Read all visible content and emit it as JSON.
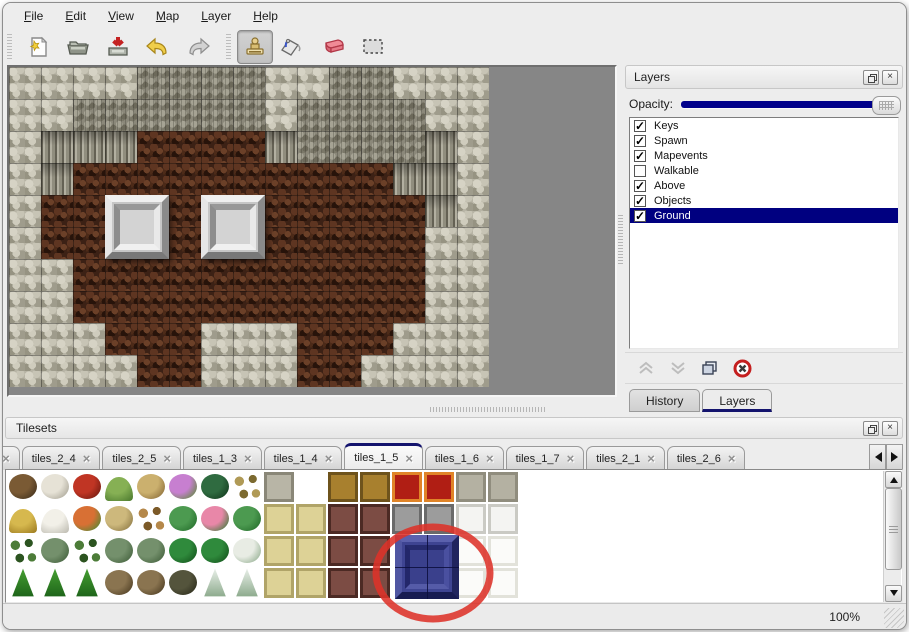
{
  "menu": {
    "items": [
      "File",
      "Edit",
      "View",
      "Map",
      "Layer",
      "Help"
    ]
  },
  "toolbar": {
    "tools": [
      "new-file",
      "open",
      "save",
      "undo",
      "redo",
      "stamp",
      "fill",
      "eraser",
      "select"
    ],
    "active_tool": "stamp"
  },
  "icons": {
    "close": "×"
  },
  "layers_panel": {
    "title": "Layers",
    "opacity_label": "Opacity:",
    "opacity_value_fraction": 1.0,
    "layers": [
      {
        "name": "Keys",
        "checked": true,
        "selected": false
      },
      {
        "name": "Spawn",
        "checked": true,
        "selected": false
      },
      {
        "name": "Mapevents",
        "checked": true,
        "selected": false
      },
      {
        "name": "Walkable",
        "checked": false,
        "selected": false
      },
      {
        "name": "Above",
        "checked": true,
        "selected": false
      },
      {
        "name": "Objects",
        "checked": true,
        "selected": false
      },
      {
        "name": "Ground",
        "checked": true,
        "selected": true
      }
    ],
    "buttons": [
      "move-layer-up",
      "move-layer-down",
      "duplicate-layer",
      "delete-layer"
    ],
    "tabs": [
      {
        "label": "History",
        "active": false
      },
      {
        "label": "Layers",
        "active": true
      }
    ],
    "colors": {
      "selection": "#000080",
      "slider": "#00008b"
    }
  },
  "tilesets_panel": {
    "title": "Tilesets",
    "tabs": [
      {
        "label": "3",
        "active": false,
        "cut": true
      },
      {
        "label": "tiles_2_4",
        "active": false
      },
      {
        "label": "tiles_2_5",
        "active": false
      },
      {
        "label": "tiles_1_3",
        "active": false
      },
      {
        "label": "tiles_1_4",
        "active": false
      },
      {
        "label": "tiles_1_5",
        "active": true
      },
      {
        "label": "tiles_1_6",
        "active": false
      },
      {
        "label": "tiles_1_7",
        "active": false
      },
      {
        "label": "tiles_2_1",
        "active": false
      },
      {
        "label": "tiles_2_6",
        "active": false
      }
    ],
    "grid": [
      [
        [
          "blob",
          "#7a5a34",
          "#40301c"
        ],
        [
          "blob",
          "#e6e2d6",
          "#a8a496"
        ],
        [
          "blob",
          "#c03524",
          "#6e1a10"
        ],
        [
          "mound",
          "#86b054",
          "#4e7c30"
        ],
        [
          "blob",
          "#cbb06e",
          "#8a6c38"
        ],
        [
          "blob",
          "#c77fd0",
          "#5e8a3c"
        ],
        [
          "blob",
          "#2f6b40",
          "#133a1e"
        ],
        [
          "sprig",
          "#b09a56",
          "#7c6a30"
        ],
        [
          "flat",
          "#b8b5a6",
          "#8a8778"
        ],
        null,
        [
          "flat",
          "#a8802e",
          "#6e531c"
        ],
        [
          "flat",
          "#a8802e",
          "#6e531c"
        ],
        [
          "flat",
          "#b01e14",
          "#e08428"
        ],
        [
          "flat",
          "#b01e14",
          "#e08428"
        ],
        [
          "flat",
          "#b4b1a2",
          "#908d7e"
        ],
        [
          "flat",
          "#b4b1a2",
          "#908d7e"
        ]
      ],
      [
        [
          "mound",
          "#d6b84e",
          "#a07e22"
        ],
        [
          "mound",
          "#f2f0e8",
          "#c0beb4"
        ],
        [
          "blob",
          "#d87034",
          "#4e8a34"
        ],
        [
          "blob",
          "#cdb87c",
          "#8c7844"
        ],
        [
          "sprig",
          "#b5884a",
          "#7c5a28"
        ],
        [
          "blob",
          "#4c9a50",
          "#256e2c"
        ],
        [
          "blob",
          "#e887a8",
          "#3c7c3c"
        ],
        [
          "blob",
          "#4c9a50",
          "#256e2c"
        ],
        [
          "flat",
          "#ddd296",
          "#b0a468"
        ],
        [
          "flat",
          "#ddd296",
          "#b0a468"
        ],
        [
          "flat",
          "#7c4c44",
          "#4c2a24"
        ],
        [
          "flat",
          "#7c4c44",
          "#4c2a24"
        ],
        [
          "flat",
          "#9c9c9c",
          "#6a6a6a"
        ],
        [
          "flat",
          "#9c9c9c",
          "#6a6a6a"
        ],
        [
          "flat",
          "#f4f4f2",
          "#cacac4"
        ],
        [
          "flat",
          "#f4f4f2",
          "#cacac4"
        ]
      ],
      [
        [
          "sprig",
          "#4c7c38",
          "#2c5420"
        ],
        [
          "blob",
          "#74906c",
          "#42603c"
        ],
        [
          "sprig",
          "#4c7c38",
          "#2c5420"
        ],
        [
          "blob",
          "#74906c",
          "#42603c"
        ],
        [
          "blob",
          "#74906c",
          "#42603c"
        ],
        [
          "blob",
          "#2f8a3c",
          "#14541c"
        ],
        [
          "blob",
          "#2f8a3c",
          "#14541c"
        ],
        [
          "blob",
          "#e8ece4",
          "#92ae90"
        ],
        [
          "flat",
          "#ddd296",
          "#b0a468"
        ],
        [
          "flat",
          "#ddd296",
          "#b0a468"
        ],
        [
          "flat",
          "#7c4c44",
          "#4c2a24"
        ],
        [
          "flat",
          "#7c4c44",
          "#4c2a24"
        ],
        null,
        null,
        [
          "flat",
          "#fbfbf9",
          "#e2e2da"
        ],
        [
          "flat",
          "#fbfbf9",
          "#e2e2da"
        ]
      ],
      [
        [
          "cone",
          "#46a032",
          "#1e641a"
        ],
        [
          "cone",
          "#46a032",
          "#1e641a"
        ],
        [
          "cone",
          "#46a032",
          "#1e641a"
        ],
        [
          "blob",
          "#8a7450",
          "#4c3c22"
        ],
        [
          "blob",
          "#8a7450",
          "#4c3c22"
        ],
        [
          "blob",
          "#54543c",
          "#2c2c1c"
        ],
        [
          "cone",
          "#eaf0ea",
          "#8caa8c"
        ],
        [
          "cone",
          "#eaf0ea",
          "#8caa8c"
        ],
        [
          "flat",
          "#ddd296",
          "#b0a468"
        ],
        [
          "flat",
          "#ddd296",
          "#b0a468"
        ],
        [
          "flat",
          "#7c4c44",
          "#4c2a24"
        ],
        [
          "flat",
          "#7c4c44",
          "#4c2a24"
        ],
        null,
        null,
        [
          "flat",
          "#fbfbf9",
          "#e2e2da"
        ],
        [
          "flat",
          "#fbfbf9",
          "#e2e2da"
        ]
      ]
    ],
    "selected_tile": {
      "col": 12,
      "row": 2,
      "span": 2,
      "color": "#3e4492"
    },
    "highlight": {
      "shape": "ellipse",
      "cx": 430,
      "cy": 570,
      "rx": 57,
      "ry": 46,
      "color": "#dd3229",
      "stroke_width": 7
    }
  },
  "map": {
    "legend": {
      "S": "stone-ground",
      "T": "cliff-top",
      "W": "cliff-wall",
      "F": "cave-floor"
    },
    "rows": [
      "SSSSTTTTSSTTSSS",
      "SSTTTTTTSTTTTSS",
      "SWWWFFFFWTTTTWS",
      "SWFFFFFFFFFFWWS",
      "SFFFFFFFFFFFFWS",
      "SFFFFFFFFFFFFSS",
      "SSFFFFFFFFFFFSS",
      "SSFFFFFFFFFFFSS",
      "SSSFFFSSSFFFSSS",
      "SSSSFFSSSFFSSSS"
    ],
    "platforms": [
      {
        "col": 3,
        "row": 4
      },
      {
        "col": 6,
        "row": 4
      }
    ]
  },
  "status": {
    "zoom": "100%"
  }
}
